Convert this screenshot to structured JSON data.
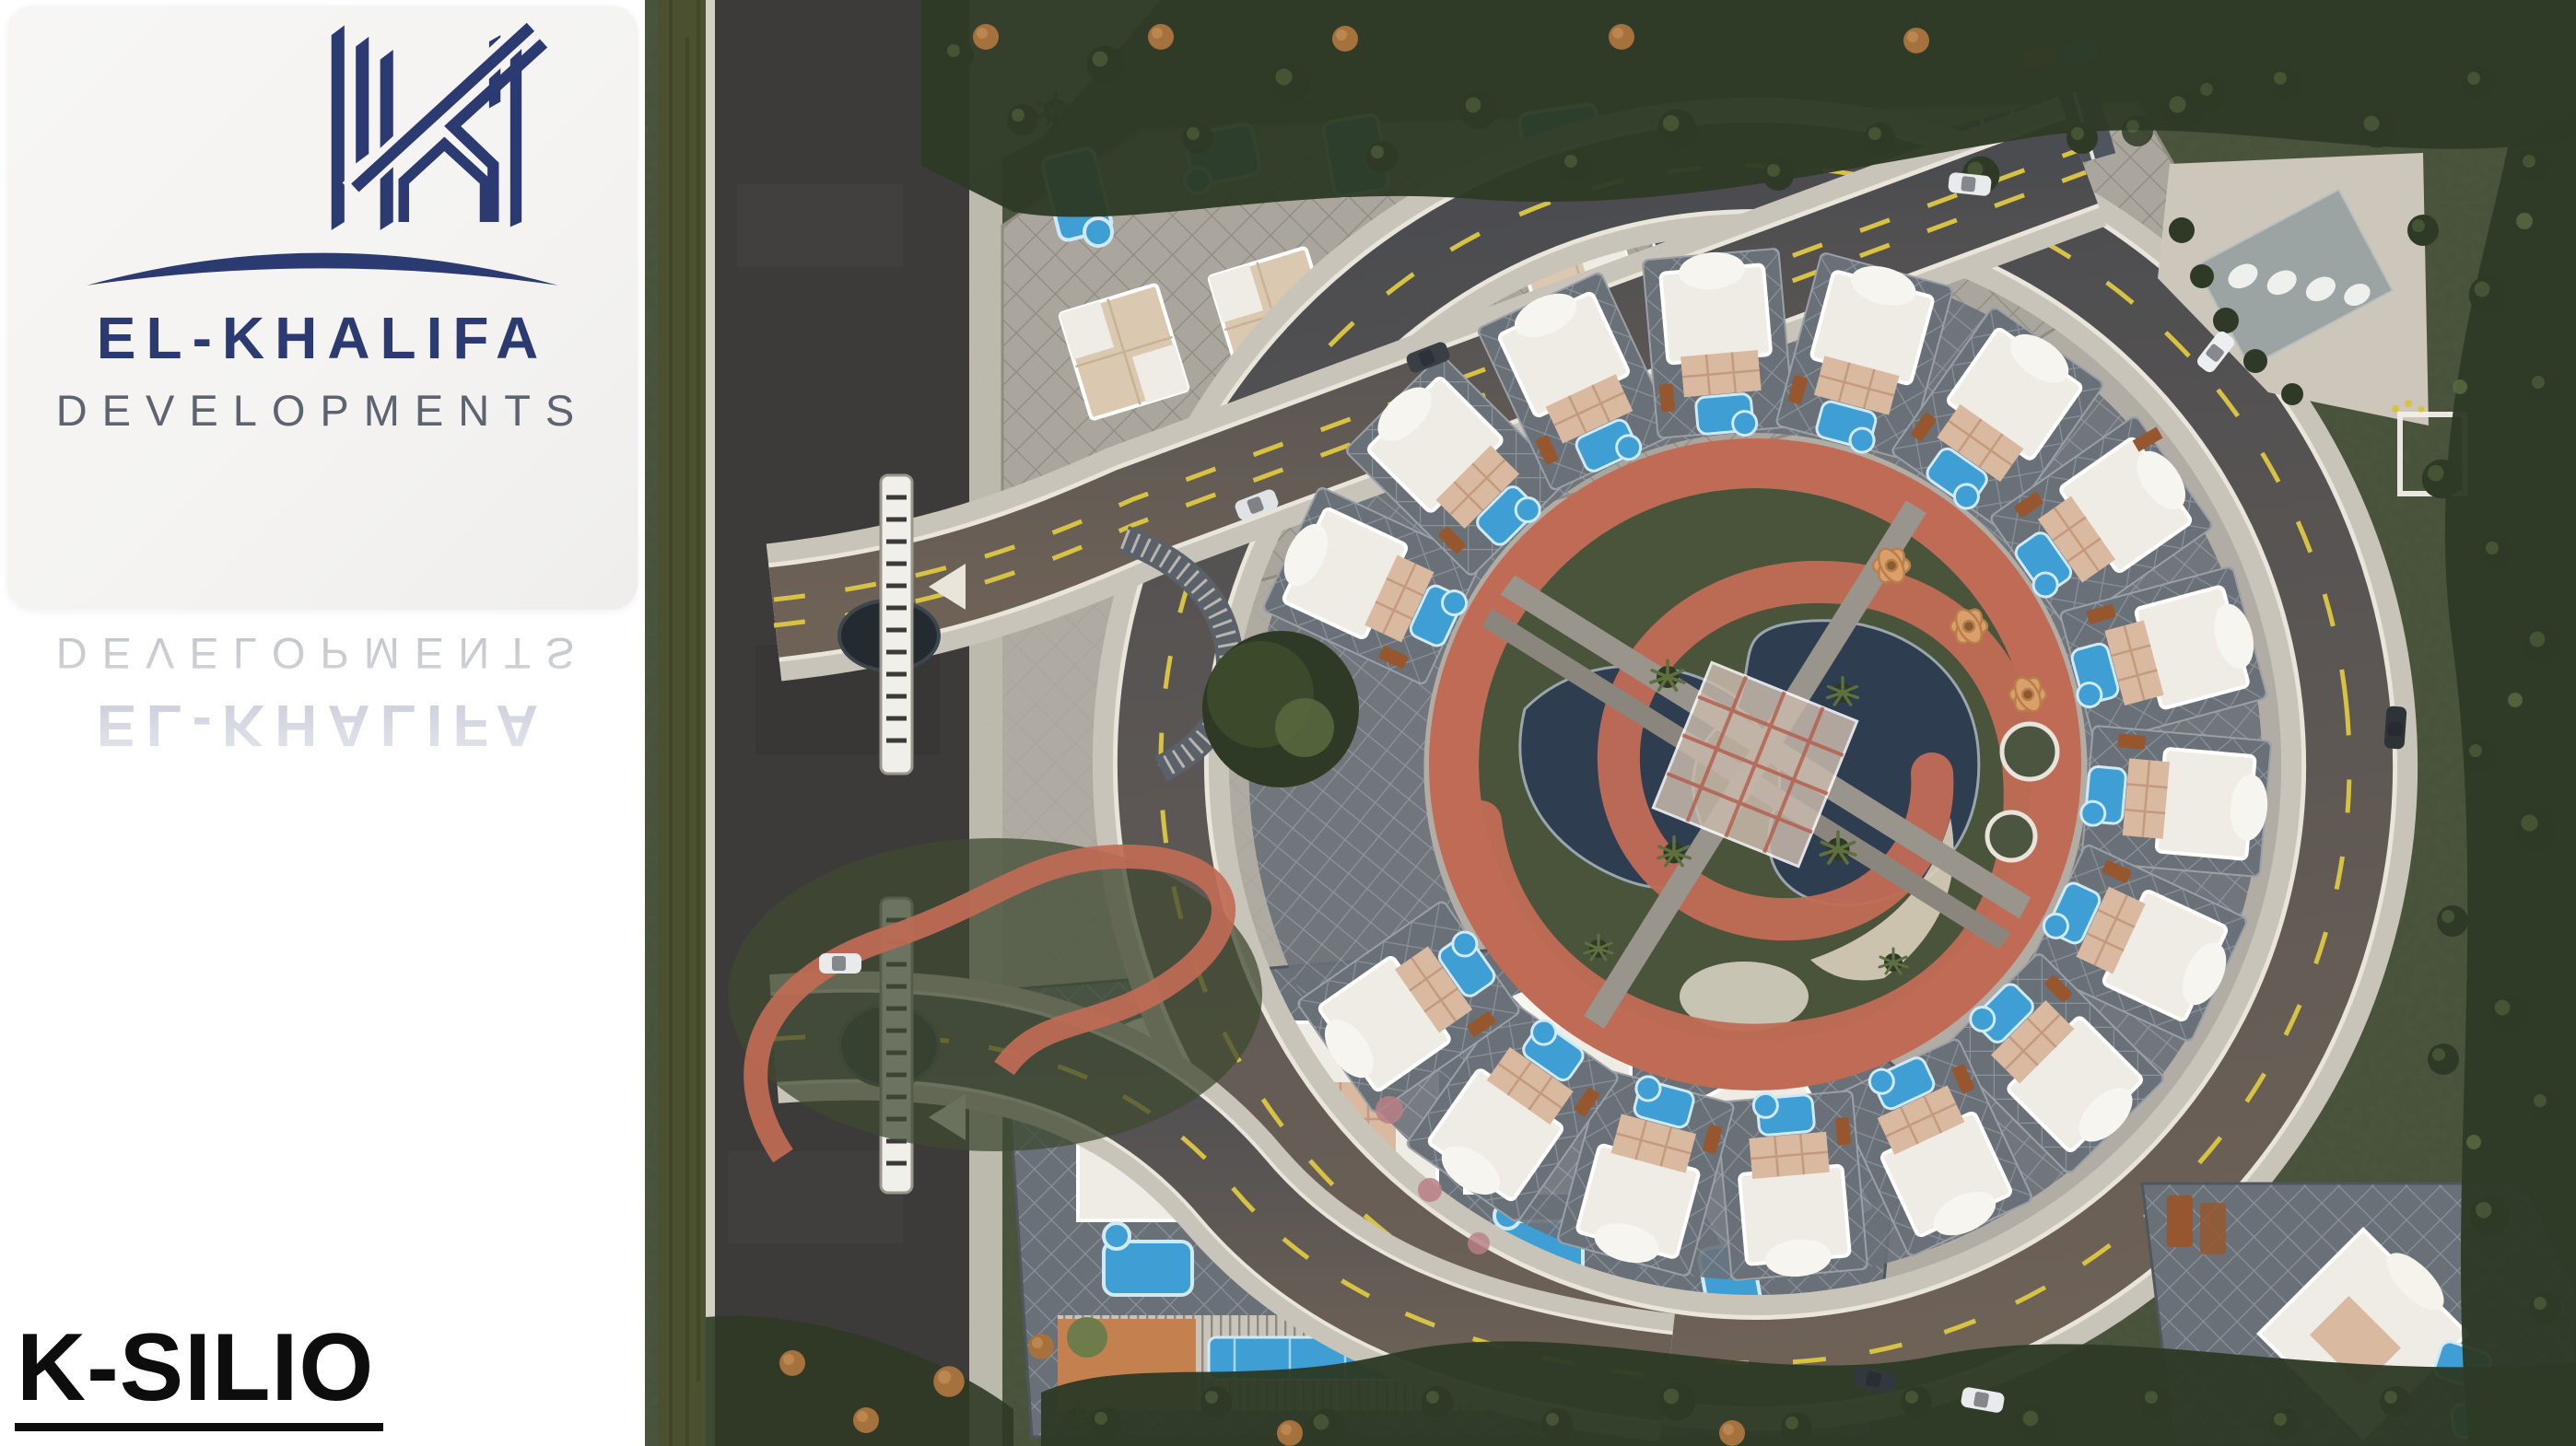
{
  "brand": {
    "name": "EL-KHALIFA",
    "division": "DEVELOPMENTS"
  },
  "project": {
    "name": "K-SILIO"
  },
  "icons": {
    "logo": "el-khalifa-buildings-k-monogram-with-arc"
  },
  "colors": {
    "panel-bg": "#ffffff",
    "card-bg": "#f4f3f1",
    "navy": "#2c3a72",
    "brand-gray": "#5c6472",
    "ink": "#0d0d0d",
    "grass": "#46503a",
    "park": "#49543b",
    "tree": "#2e3a25",
    "tree-light": "#5a6a42",
    "tree-orange": "#a5713c",
    "hedge": "#4b5030",
    "asphalt": "#3c3b39",
    "road": "#4b4c50",
    "road-warm": "#6e6257",
    "sidewalk": "#c9c4b9",
    "paving": "#b1ada5",
    "yellow": "#d7c243",
    "track": "#c06b55",
    "pond": "#2e3e50",
    "pool": "#3f9fd4",
    "pool-rim": "#cfeaf6",
    "sand": "#d8cdb8",
    "villa": "#efece5",
    "terrace": "#d9b9a0",
    "deck": "#c4814f",
    "bench": "#96572e",
    "canopy": "#9aa3a3",
    "pink": "#b97f86",
    "white-line": "#e9e5db"
  }
}
